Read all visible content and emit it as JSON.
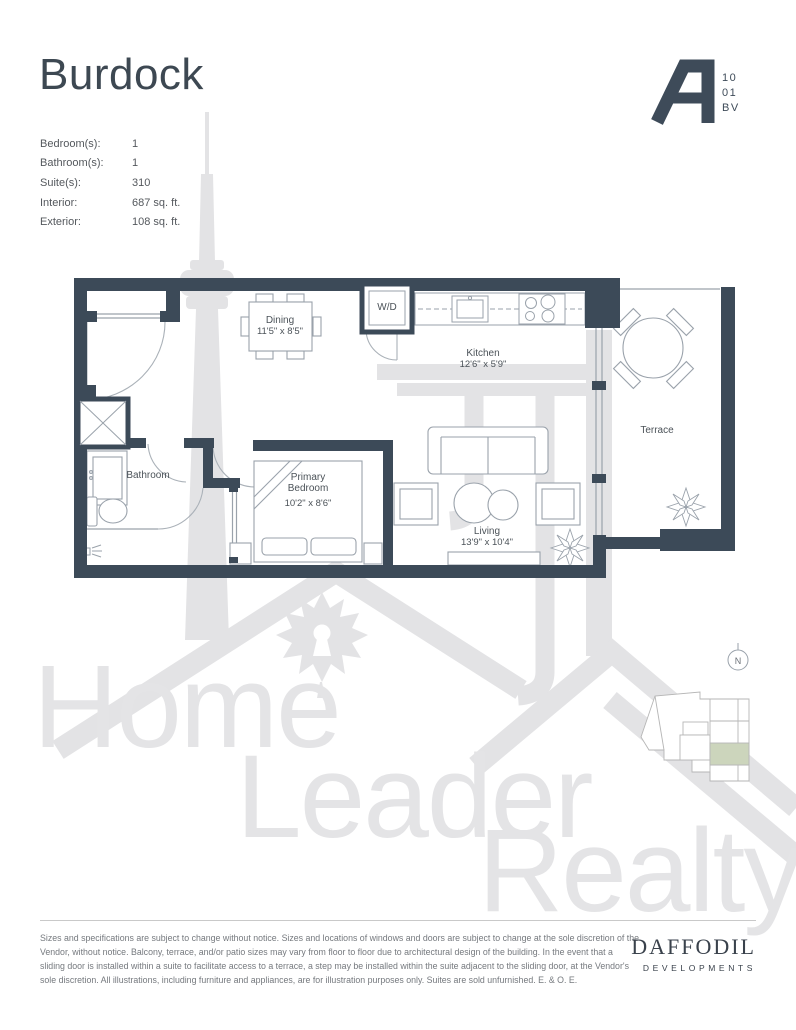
{
  "page_title": "Burdock",
  "unit_badge": {
    "letter": "A",
    "stack": [
      "10",
      "01",
      "BV"
    ]
  },
  "specs": [
    {
      "label": "Bedroom(s):",
      "value": "1"
    },
    {
      "label": "Bathroom(s):",
      "value": "1"
    },
    {
      "label": "Suite(s):",
      "value": "310"
    },
    {
      "label": "Interior:",
      "value": "687 sq. ft."
    },
    {
      "label": "Exterior:",
      "value": "108 sq. ft."
    }
  ],
  "floorplan": {
    "rooms": [
      {
        "name": "Dining",
        "dims": "11'5\" x 8'5\""
      },
      {
        "name": "Kitchen",
        "dims": "12'6\" x 5'9\""
      },
      {
        "name": "Bathroom",
        "dims": ""
      },
      {
        "name": "Primary",
        "name2": "Bedroom",
        "dims": "10'2\" x 8'6\""
      },
      {
        "name": "Living",
        "dims": "13'9\" x 10'4\""
      },
      {
        "name": "Terrace",
        "dims": ""
      },
      {
        "name": "W/D",
        "dims": ""
      }
    ],
    "north_label": "N"
  },
  "watermark": {
    "words": [
      "Home",
      "Leader",
      "Realty"
    ]
  },
  "footer": {
    "disclaimer": "Sizes and specifications are subject to change without notice. Sizes and locations of windows and doors are subject to change at the sole discretion of the Vendor, without notice. Balcony, terrace, and/or patio sizes may vary from floor to floor due to architectural design of the building. In the event that a sliding door is installed within a suite to facilitate access to a terrace, a step may be installed within the suite adjacent to the sliding door, at the Vendor's sole discretion. All illustrations, including furniture and appliances, are for illustration purposes only. Suites are sold unfurnished. E. & O. E.",
    "developer_name": "DAFFODIL",
    "developer_subtitle": "DEVELOPMENTS"
  },
  "colors": {
    "wall": "#3c4a58",
    "watermark": "#e3e3e5",
    "keyplan_highlight": "#ccd5bc",
    "text_dark": "#3d4852",
    "text_gray": "#54585d"
  }
}
